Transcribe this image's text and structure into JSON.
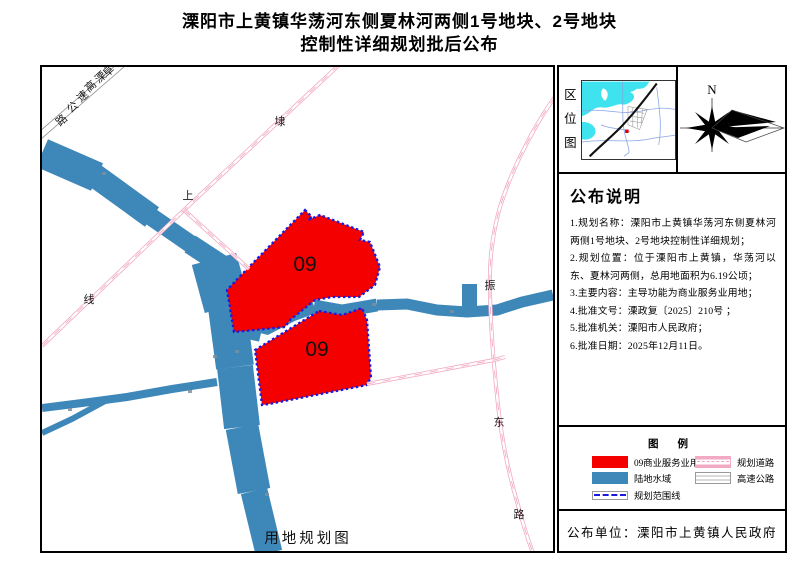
{
  "title": {
    "line1": "溧阳市上黄镇华荡河东侧夏林河两侧1号地块、2号地块",
    "line2": "控制性详细规划批后公布"
  },
  "map": {
    "caption": "用地规划图",
    "parcels": [
      {
        "label": "09"
      },
      {
        "label": "09"
      }
    ],
    "roads": {
      "expressway": {
        "name": "阜溧高速公路",
        "chars": [
          "路",
          "公",
          "速",
          "高",
          "溧",
          "阜"
        ]
      },
      "daishang": {
        "name": "埭上线",
        "chars": [
          "埭",
          "上",
          "线"
        ]
      },
      "zhendong": {
        "name": "振东路",
        "chars": [
          "振",
          "东",
          "路"
        ]
      }
    }
  },
  "location_map": {
    "title_chars": [
      "区",
      "位",
      "图"
    ]
  },
  "compass": {
    "north_label": "N"
  },
  "notes": {
    "title": "公布说明",
    "items": [
      "1.规划名称：溧阳市上黄镇华荡河东侧夏林河两侧1号地块、2号地块控制性详细规划；",
      "2.规划位置：位于溧阳市上黄镇，华荡河以东、夏林河两侧，总用地面积为6.19公顷；",
      "3.主要内容：主导功能为商业服务业用地；",
      "4.批准文号：溧政复〔2025〕210号 ；",
      "5.批准机关：溧阳市人民政府；",
      "6.批准日期：2025年12月11日。"
    ]
  },
  "legend": {
    "title": "图  例",
    "items": [
      {
        "label": "09商业服务业用地",
        "swatch": "red-fill"
      },
      {
        "label": "陆地水域",
        "swatch": "blue-fill"
      },
      {
        "label": "规划范围线",
        "swatch": "blue-dashed-line"
      },
      {
        "label": "规划道路",
        "swatch": "pink-road"
      },
      {
        "label": "高速公路",
        "swatch": "highway"
      }
    ]
  },
  "publisher": {
    "text": "公布单位：溧阳市上黄镇人民政府"
  },
  "colors": {
    "parcel_red": "#f40000",
    "water_blue": "#3e87b9",
    "boundary_blue": "#1a1ade",
    "road_pink": "#f2aac4",
    "inset_cyan": "#3fe2ef"
  }
}
